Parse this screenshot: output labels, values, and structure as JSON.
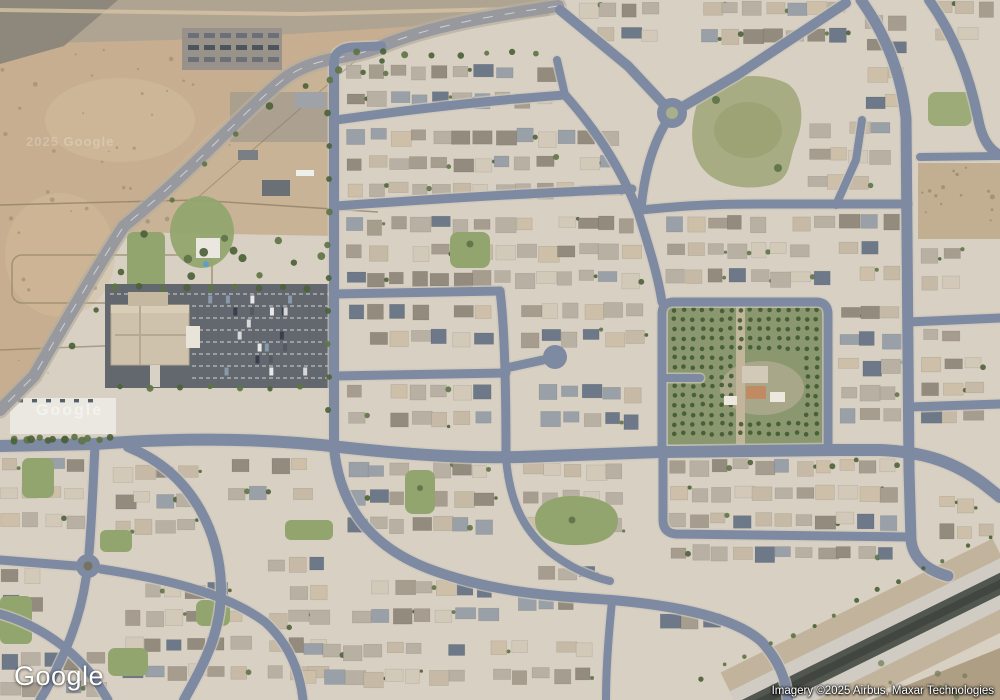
{
  "overlay": {
    "logo": "Google",
    "attribution": "Imagery ©2025 Airbus, Maxar Technologies",
    "watermark_desert": "2025 Google",
    "watermark_pad": "Google"
  },
  "palette": {
    "ground": "#d8d0c2",
    "desert": "#c7ae90",
    "desert_gravel": "#aaa193",
    "desert_dark": "#8e877b",
    "farm_dirt": "#c9b397",
    "road": "#7e8aa2",
    "road_casing": "#cdc8bc",
    "road_desert": "#97999e",
    "road_desert_casing": "#b7ae9d",
    "park": "#93a56e",
    "park_dry": "#a8ac83",
    "orchard_ground": "#8b986f",
    "orchard_tree": "#3f5a33",
    "tree": "#5e7446",
    "tree_dark": "#4c6238",
    "parking_lot": "#63686f",
    "building_tan": "#cfc2ac",
    "building_white": "#eceae4",
    "pad_white": "#eae8e1",
    "canal_water": "#51564f",
    "canal_water_dark": "#3e423d",
    "canal_bank": "#d0ccc3",
    "canal_dirt": "#c2b49c",
    "corner_dirt": "#ae9e84",
    "dirt_lot": "#c2ae90",
    "houses": [
      "#b8b0a2",
      "#c6baa6",
      "#a79d8f",
      "#d2c9b9",
      "#938b7d",
      "#cdbfa8",
      "#9aa0a8",
      "#6d7888"
    ]
  }
}
